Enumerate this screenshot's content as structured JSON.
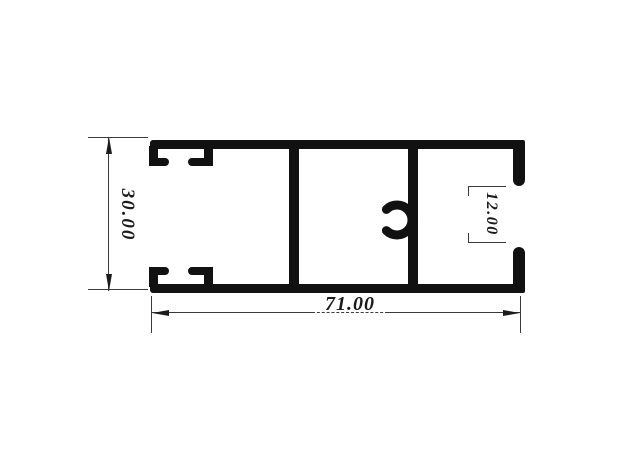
{
  "drawing": {
    "title": "aluminum extrusion profile cross-section",
    "ink_color": "#111111",
    "dim_line_color": "#3a3a3a",
    "background_color": "#ffffff",
    "dimensions": {
      "height": "30.00",
      "width": "71.00",
      "opening": "12.00"
    }
  }
}
